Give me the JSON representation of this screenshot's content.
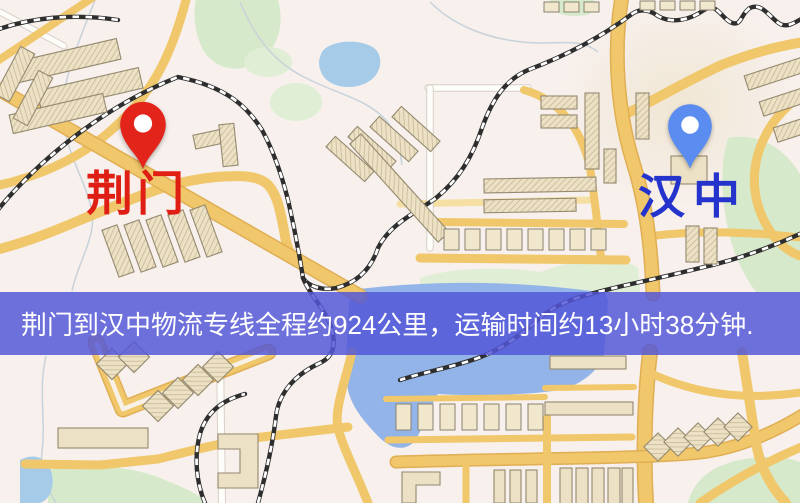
{
  "map": {
    "origin": {
      "label": "荆门"
    },
    "destination": {
      "label": "汉中"
    },
    "banner": {
      "text": "荆门到汉中物流专线全程约924公里，运输时间约13小时38分钟."
    },
    "icons": {
      "origin_pin_icon": "red-location-pin",
      "destination_pin_icon": "blue-location-pin"
    }
  },
  "colors": {
    "map-base": "#f7f0ec",
    "pin-origin": "#e3241b",
    "label-origin": "#e01f14",
    "pin-destination": "#5b8cf0",
    "label-destination": "#2433cc",
    "banner-bg": "rgba(82,86,216,0.84)",
    "banner-text": "#ffffff"
  }
}
